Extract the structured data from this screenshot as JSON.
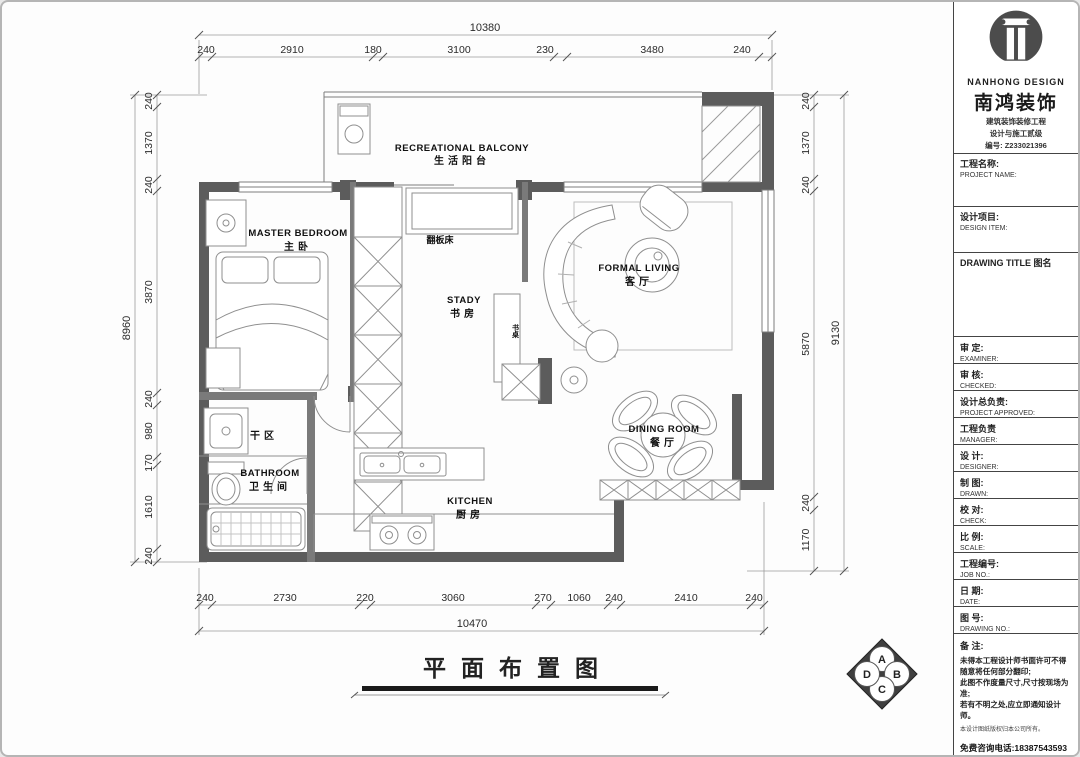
{
  "page": {
    "plan_title": "平面布置图"
  },
  "brand": {
    "name_en": "NANHONG DESIGN",
    "name_cn": "南鸿装饰",
    "cert_line1": "建筑装饰装修工程",
    "cert_line2": "设计与施工贰级",
    "cert_no": "编号: Z233021396"
  },
  "title_block": {
    "fields": [
      {
        "cn": "工程名称:",
        "en": "PROJECT NAME:"
      },
      {
        "cn": "设计项目:",
        "en": "DESIGN ITEM:"
      },
      {
        "cn": "DRAWING TITLE 图名",
        "en": ""
      },
      {
        "cn": "审  定:",
        "en": "EXAMINER:"
      },
      {
        "cn": "审  核:",
        "en": "CHECKED:"
      },
      {
        "cn": "设计总负责:",
        "en": "PROJECT APPROVED:"
      },
      {
        "cn": "工程负责",
        "en": "MANAGER:"
      },
      {
        "cn": "设  计:",
        "en": "DESIGNER:"
      },
      {
        "cn": "制  图:",
        "en": "DRAWN:"
      },
      {
        "cn": "校  对:",
        "en": "CHECK:"
      },
      {
        "cn": "比  例:",
        "en": "SCALE:"
      },
      {
        "cn": "工程编号:",
        "en": "JOB NO.:"
      },
      {
        "cn": "日  期:",
        "en": "DATE:"
      },
      {
        "cn": "图  号:",
        "en": "DRAWING NO.:"
      }
    ]
  },
  "notes": {
    "heading": "备  注:",
    "lines": [
      "未得本工程设计师书面许可不得随意将任何部分翻印;",
      "此图不作度量尺寸,尺寸按现场为准;",
      "若有不明之处,应立即通知设计师。",
      "本设计图纸版权归本公司所有。"
    ],
    "phone": "免费咨询电话:18387543593"
  },
  "rooms": {
    "balcony": {
      "en": "RECREATIONAL BALCONY",
      "cn": "生活阳台"
    },
    "master": {
      "en": "MASTER BEDROOM",
      "cn": "主卧"
    },
    "study": {
      "en": "STADY",
      "cn": "书房"
    },
    "living": {
      "en": "FORMAL LIVING",
      "cn": "客厅"
    },
    "dining": {
      "en": "DINING ROOM",
      "cn": "餐厅"
    },
    "bathroom": {
      "en": "BATHROOM",
      "cn": "卫生间"
    },
    "kitchen": {
      "en": "KITCHEN",
      "cn": "厨房"
    },
    "dry_area": {
      "cn": "干区"
    },
    "murphy_bed": {
      "cn": "翻板床"
    },
    "desk": {
      "cn": "书桌"
    }
  },
  "dims": {
    "top": {
      "total": "10380",
      "segments": [
        "240",
        "2910",
        "180",
        "3100",
        "230",
        "3480",
        "240"
      ]
    },
    "bottom": {
      "total": "10470",
      "segments": [
        "240",
        "2730",
        "220",
        "3060",
        "270",
        "1060",
        "240",
        "2410",
        "240"
      ]
    },
    "left": {
      "total": "8960",
      "segments": [
        "240",
        "1370",
        "240",
        "3870",
        "240",
        "980",
        "170",
        "1610",
        "240"
      ]
    },
    "right": {
      "total": "9130",
      "segments": [
        "240",
        "1370",
        "240",
        "5870",
        "240",
        "1170"
      ]
    }
  },
  "compass": {
    "top": "A",
    "right": "B",
    "bottom": "C",
    "left": "D"
  },
  "colors": {
    "wall": "#5c5c5c",
    "partition": "#7a7a7a",
    "line": "#8f8f8f",
    "dimline": "#9a9a9a"
  }
}
